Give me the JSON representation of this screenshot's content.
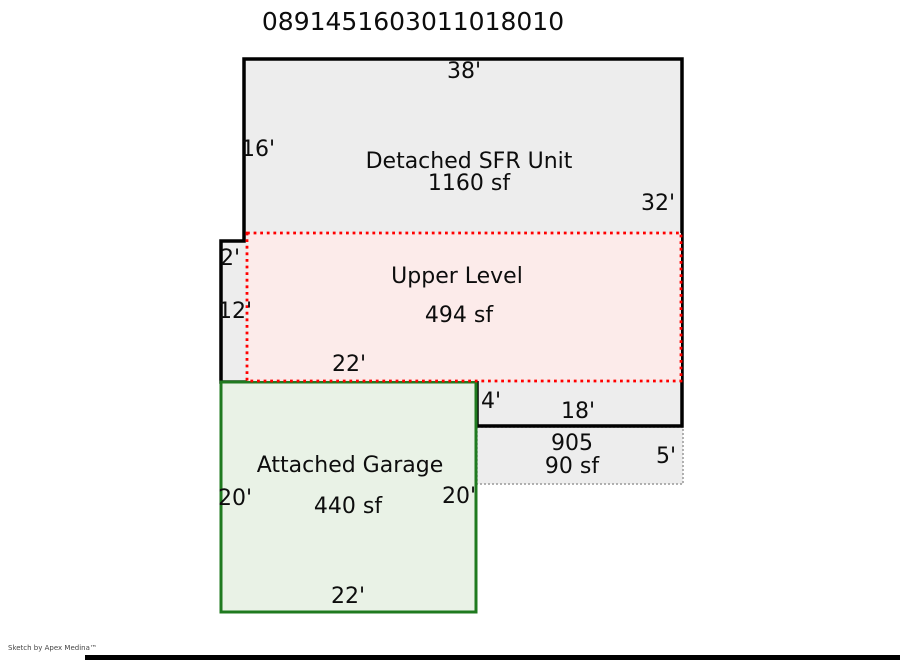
{
  "title": "0891451603011018010",
  "watermark": "Sketch by Apex Medina™",
  "colors": {
    "wall": "#000000",
    "building_fill": "#ededed",
    "upper_fill": "#fcebea",
    "upper_border": "#ff0000",
    "garage_fill": "#e9f2e6",
    "garage_border": "#1f7a1f",
    "porch_border": "#999999"
  },
  "sketch": {
    "sfr": {
      "name": "Detached SFR Unit",
      "area": "1160 sf"
    },
    "upper": {
      "name": "Upper Level",
      "area": "494 sf"
    },
    "garage": {
      "name": "Attached Garage",
      "area": "440 sf"
    },
    "porch": {
      "code": "905",
      "area": "90 sf"
    },
    "dims": {
      "sfr_top": "38'",
      "sfr_left_upper": "16'",
      "sfr_right": "32'",
      "step": "2'",
      "sfr_left_lower": "12'",
      "sfr_bottom": "22'",
      "jog": "4'",
      "porch_top": "18'",
      "porch_right": "5'",
      "garage_left": "20'",
      "garage_right": "20'",
      "garage_bottom": "22'"
    }
  }
}
